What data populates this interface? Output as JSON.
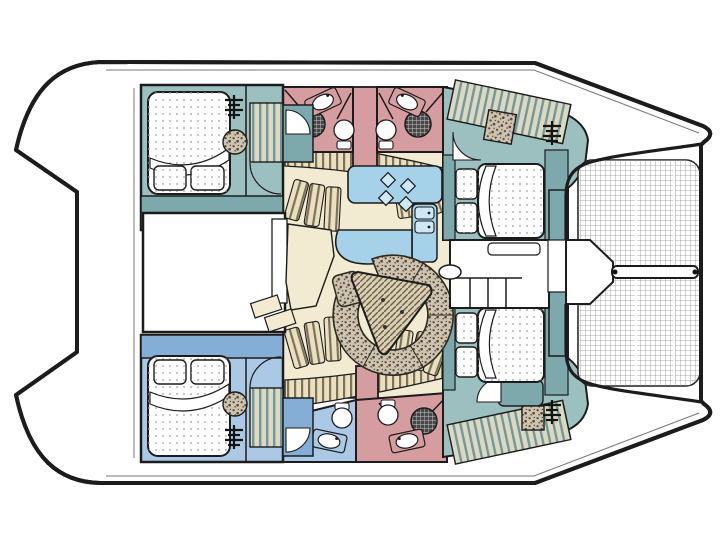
{
  "meta": {
    "title": "Catamaran yacht interior layout — top-view floor plan",
    "figure_type": "boat floor plan diagram",
    "orientation": {
      "bow": "right",
      "stern": "left",
      "port_hull": "top",
      "starboard_hull": "bottom"
    }
  },
  "palette": {
    "outline": "#1c1c1c",
    "deckWhite": "#ffffff",
    "tealFloor": "#9cbfc0",
    "tealCabinet": "#7da9ac",
    "blueFloor": "#abc9e5",
    "blueCabinet": "#84aed6",
    "pink": "#d69da1",
    "cream": "#f2ead1",
    "stripeBase": "#eae0bf",
    "stripeLine": "#7c725a",
    "wardBase": "#ddd8c2",
    "wardLine": "#72989b",
    "galleyBlue": "#a5d2e9",
    "galleyBlueLight": "#cfe8f4",
    "speckleBase": "#cdc3ae",
    "speckleDot": "#51483a",
    "hatchBase": "#d9cfb4",
    "hatchLine": "#6b6046",
    "netLine": "#8f8f8f",
    "bedDot": "#9aa0a0",
    "showerDark": "#474747",
    "showerLight": "#c9c9c9",
    "toeRail": "#777777"
  },
  "areas": {
    "trampoline": {
      "label": "Bow trampoline net"
    },
    "bowsprit": {
      "label": "Bowsprit beam"
    },
    "foredeck": {
      "label": "Forward nacelle platform and steps"
    },
    "aft_cockpit": {
      "label": "Aft cockpit"
    },
    "salon": {
      "label": "Salon — curved settee with triangular table"
    },
    "galley": {
      "label": "Galley — 4-burner stove and double sink",
      "burners": 4,
      "sink_basins": 2
    },
    "nav_desk": {
      "label": "Chart desk / cabinetry"
    },
    "cabins": [
      {
        "id": "port-aft",
        "label": "Double cabin — port aft",
        "features": [
          "double bed",
          "wardrobe",
          "companionway ladder",
          "pouf"
        ]
      },
      {
        "id": "port-forward",
        "label": "Double cabin — port forward",
        "features": [
          "double bed",
          "wardrobe",
          "companionway ladder",
          "locker"
        ]
      },
      {
        "id": "starboard-aft",
        "label": "Double cabin — starboard aft",
        "features": [
          "double bed",
          "wardrobe",
          "companionway ladder",
          "pouf"
        ]
      },
      {
        "id": "starboard-forward",
        "label": "Double cabin — starboard forward",
        "features": [
          "double bed",
          "wardrobe",
          "companionway ladder",
          "locker"
        ]
      }
    ],
    "heads": [
      {
        "id": "port-aft-head",
        "label": "Head — port aft",
        "fixtures": [
          "washbasin",
          "shower",
          "toilet"
        ]
      },
      {
        "id": "port-forward-head",
        "label": "Head — port forward",
        "fixtures": [
          "washbasin",
          "shower",
          "toilet"
        ]
      },
      {
        "id": "starboard-aft-head",
        "label": "Head — starboard aft",
        "fixtures": [
          "washbasin",
          "toilet"
        ]
      },
      {
        "id": "starboard-forward-head",
        "label": "Head — starboard forward",
        "fixtures": [
          "washbasin",
          "shower",
          "toilet"
        ]
      }
    ]
  }
}
